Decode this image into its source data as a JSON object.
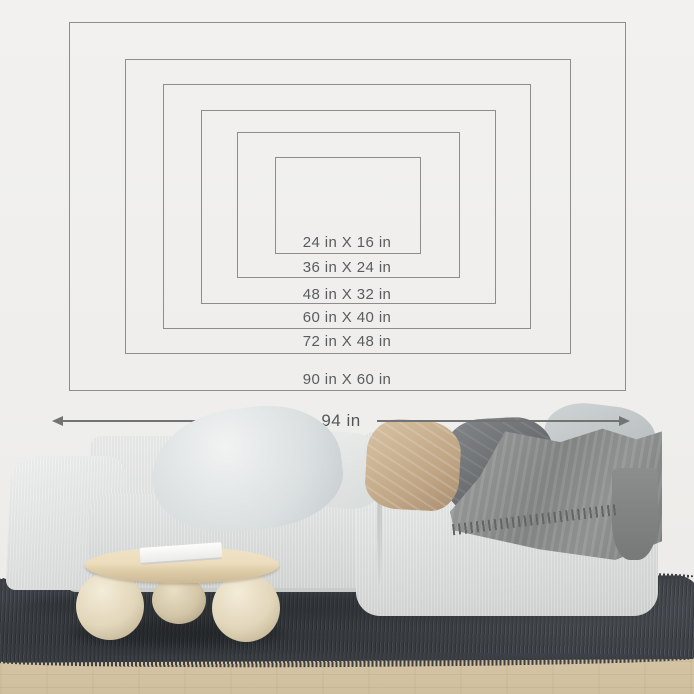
{
  "diagram": {
    "title_hint": "wall art size comparison guide",
    "sizes": [
      {
        "label": "24 in X 16 in",
        "width_in": 24,
        "height_in": 16
      },
      {
        "label": "36 in X 24 in",
        "width_in": 36,
        "height_in": 24
      },
      {
        "label": "48 in X 32 in",
        "width_in": 48,
        "height_in": 32
      },
      {
        "label": "60 in X 40 in",
        "width_in": 60,
        "height_in": 40
      },
      {
        "label": "72 in X 48 in",
        "width_in": 72,
        "height_in": 48
      },
      {
        "label": "90 in X 60 in",
        "width_in": 90,
        "height_in": 60
      }
    ],
    "sofa_width_label": "94 in",
    "line_color": "#8d8d8b",
    "label_color": "#595c5e",
    "arrow_color": "#717473"
  },
  "scene": {
    "objects": [
      "wall",
      "wood-floor",
      "shaggy-rug",
      "sofa",
      "pillows",
      "throw-blanket",
      "round-coffee-table",
      "magazine"
    ],
    "colors": {
      "wall": "#f1f0ee",
      "sofa_fabric": "#dfe2e1",
      "pillow_light_gray": "#dadfe0",
      "pillow_beige": "#c6ac8d",
      "pillow_dark_gray": "#6d7072",
      "throw_blanket": "#8d908e",
      "rug": "#42464b",
      "floor_wood": "#d8c8a9",
      "table_wood": "#ecddbd",
      "table_ball_legs": "#e2d6ba"
    }
  }
}
